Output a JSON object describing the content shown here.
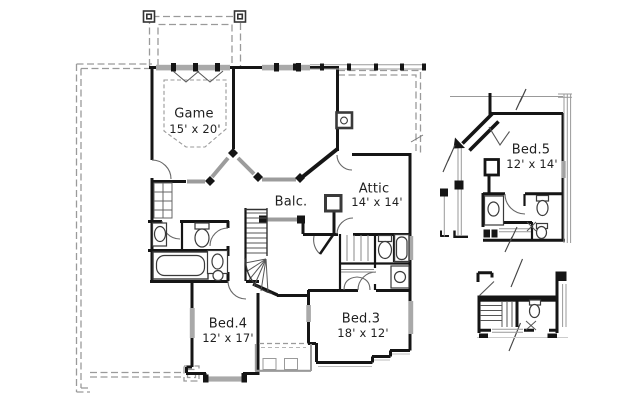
{
  "plan": {
    "type": "floor-plan",
    "rooms": [
      {
        "id": "game",
        "name": "Game",
        "dims": "15' x 20'"
      },
      {
        "id": "balc",
        "name": "Balc.",
        "dims": ""
      },
      {
        "id": "attic",
        "name": "Attic",
        "dims": "14' x 14'"
      },
      {
        "id": "bed4",
        "name": "Bed.4",
        "dims": "12' x 17'"
      },
      {
        "id": "bed3",
        "name": "Bed.3",
        "dims": "18' x 12'"
      },
      {
        "id": "bed5",
        "name": "Bed.5",
        "dims": "12' x 14'"
      }
    ],
    "colors": {
      "wall": "#151515",
      "window_gray": "#a9a9a9",
      "railing_gray": "#9c9c9c",
      "roof_dash_gray": "#9a9a9a",
      "background": "#ffffff"
    }
  }
}
